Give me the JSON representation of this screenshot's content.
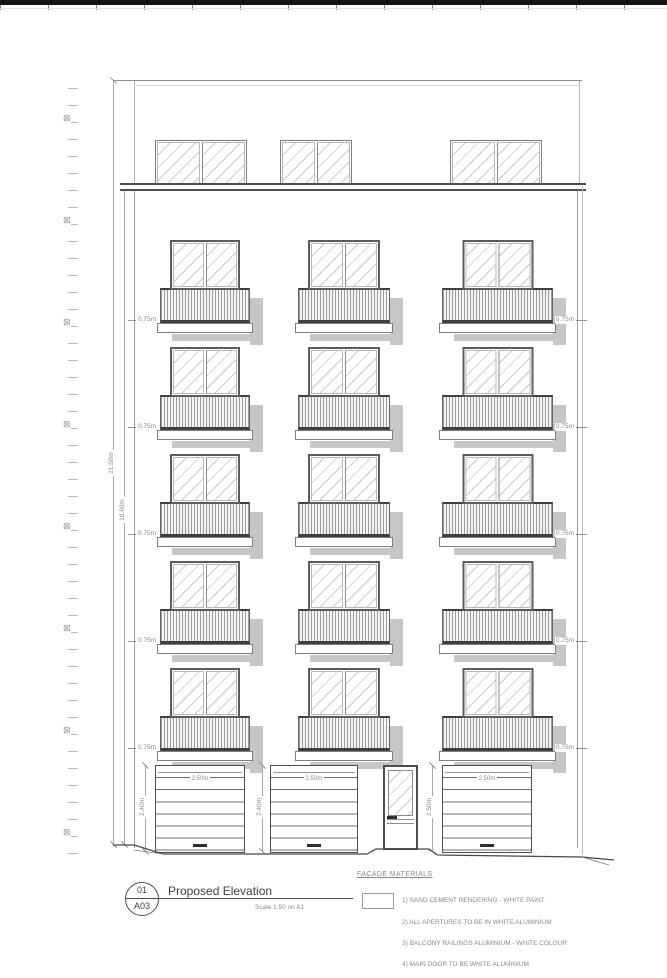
{
  "page": {
    "title_block": {
      "detail_number": "01",
      "sheet_number": "A03",
      "title": "Proposed Elevation",
      "scale_note": "Scale 1:50 on A1"
    },
    "facade_materials": {
      "heading": "FACADE MATERIALS",
      "items": [
        "1) SAND CEMENT RENDERING - WHITE PAINT",
        "2) ALL APERTURES TO BE IN WHITE ALUMINIUM",
        "3) BALCONY RAILINGS ALUMINIUM - WHITE COLOUR",
        "4) MAIN DOOR TO BE WHITE ALUMINIUM"
      ]
    },
    "dimensions": {
      "overall_height": "21.50m",
      "facade_height": "18.60m",
      "balcony_rail": "0.75m",
      "garage_width": "2.50m",
      "garage_heights": [
        "2.40m",
        "2.40m",
        "2.50m"
      ]
    },
    "icons": {
      "crossed_box": "⊠"
    },
    "colors": {
      "line_dark": "#4e4e4e",
      "line_mid": "#9a9a9a",
      "dim_text": "#8a8a8a",
      "shadow": "#c6c6c6",
      "hatch": "#c9c9c9",
      "paper": "#ffffff"
    }
  }
}
